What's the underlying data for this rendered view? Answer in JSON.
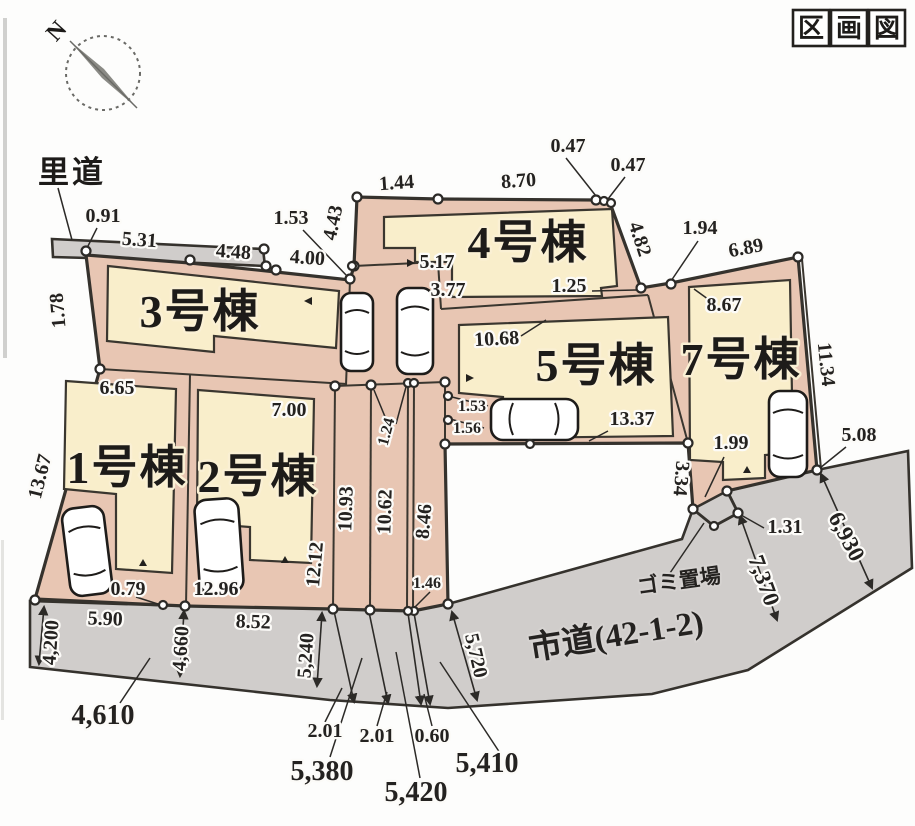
{
  "title": {
    "text": "区画図",
    "chars": [
      "区",
      "画",
      "図"
    ]
  },
  "compass": {
    "label": "N"
  },
  "roads": {
    "satomichi_label": "里道",
    "shido_label": "市道(42-1-2)",
    "garbage_label": "ゴミ置場"
  },
  "buildings": {
    "b1": "1号棟",
    "b2": "2号棟",
    "b3": "3号棟",
    "b4": "4号棟",
    "b5": "5号棟",
    "b7": "7号棟"
  },
  "dims": {
    "d091": "0.91",
    "d531": "5.31",
    "d448": "4.48",
    "d400": "4.00",
    "d178": "1.78",
    "d153a": "1.53",
    "d443": "4.43",
    "d144": "1.44",
    "d870": "8.70",
    "d047a": "0.47",
    "d047b": "0.47",
    "d482": "4.82",
    "d194": "1.94",
    "d689": "6.89",
    "d517": "5.17",
    "d377": "3.77",
    "d125": "1.25",
    "d1068": "10.68",
    "d867": "8.67",
    "d1134": "11.34",
    "d665": "6.65",
    "d700": "7.00",
    "d153b": "1.53",
    "d156": "1.56",
    "d124": "1.24",
    "d1337": "13.37",
    "d199": "1.99",
    "d508": "5.08",
    "d334": "3.34",
    "d1367": "13.67",
    "d1093": "10.93",
    "d1062": "10.62",
    "d846": "8.46",
    "d1212": "12.12",
    "d131": "1.31",
    "d7370": "7,370",
    "d6930": "6,930",
    "d079": "0.79",
    "d1296": "12.96",
    "d146": "1.46",
    "d590": "5.90",
    "d852": "8.52",
    "d4200": "4,200",
    "d4660": "4,660",
    "d5240": "5,240",
    "d5720": "5,720",
    "d4610": "4,610",
    "d201a": "2.01",
    "d201b": "2.01",
    "d060": "0.60",
    "d5380": "5,380",
    "d5420": "5,420",
    "d5410": "5,410"
  }
}
